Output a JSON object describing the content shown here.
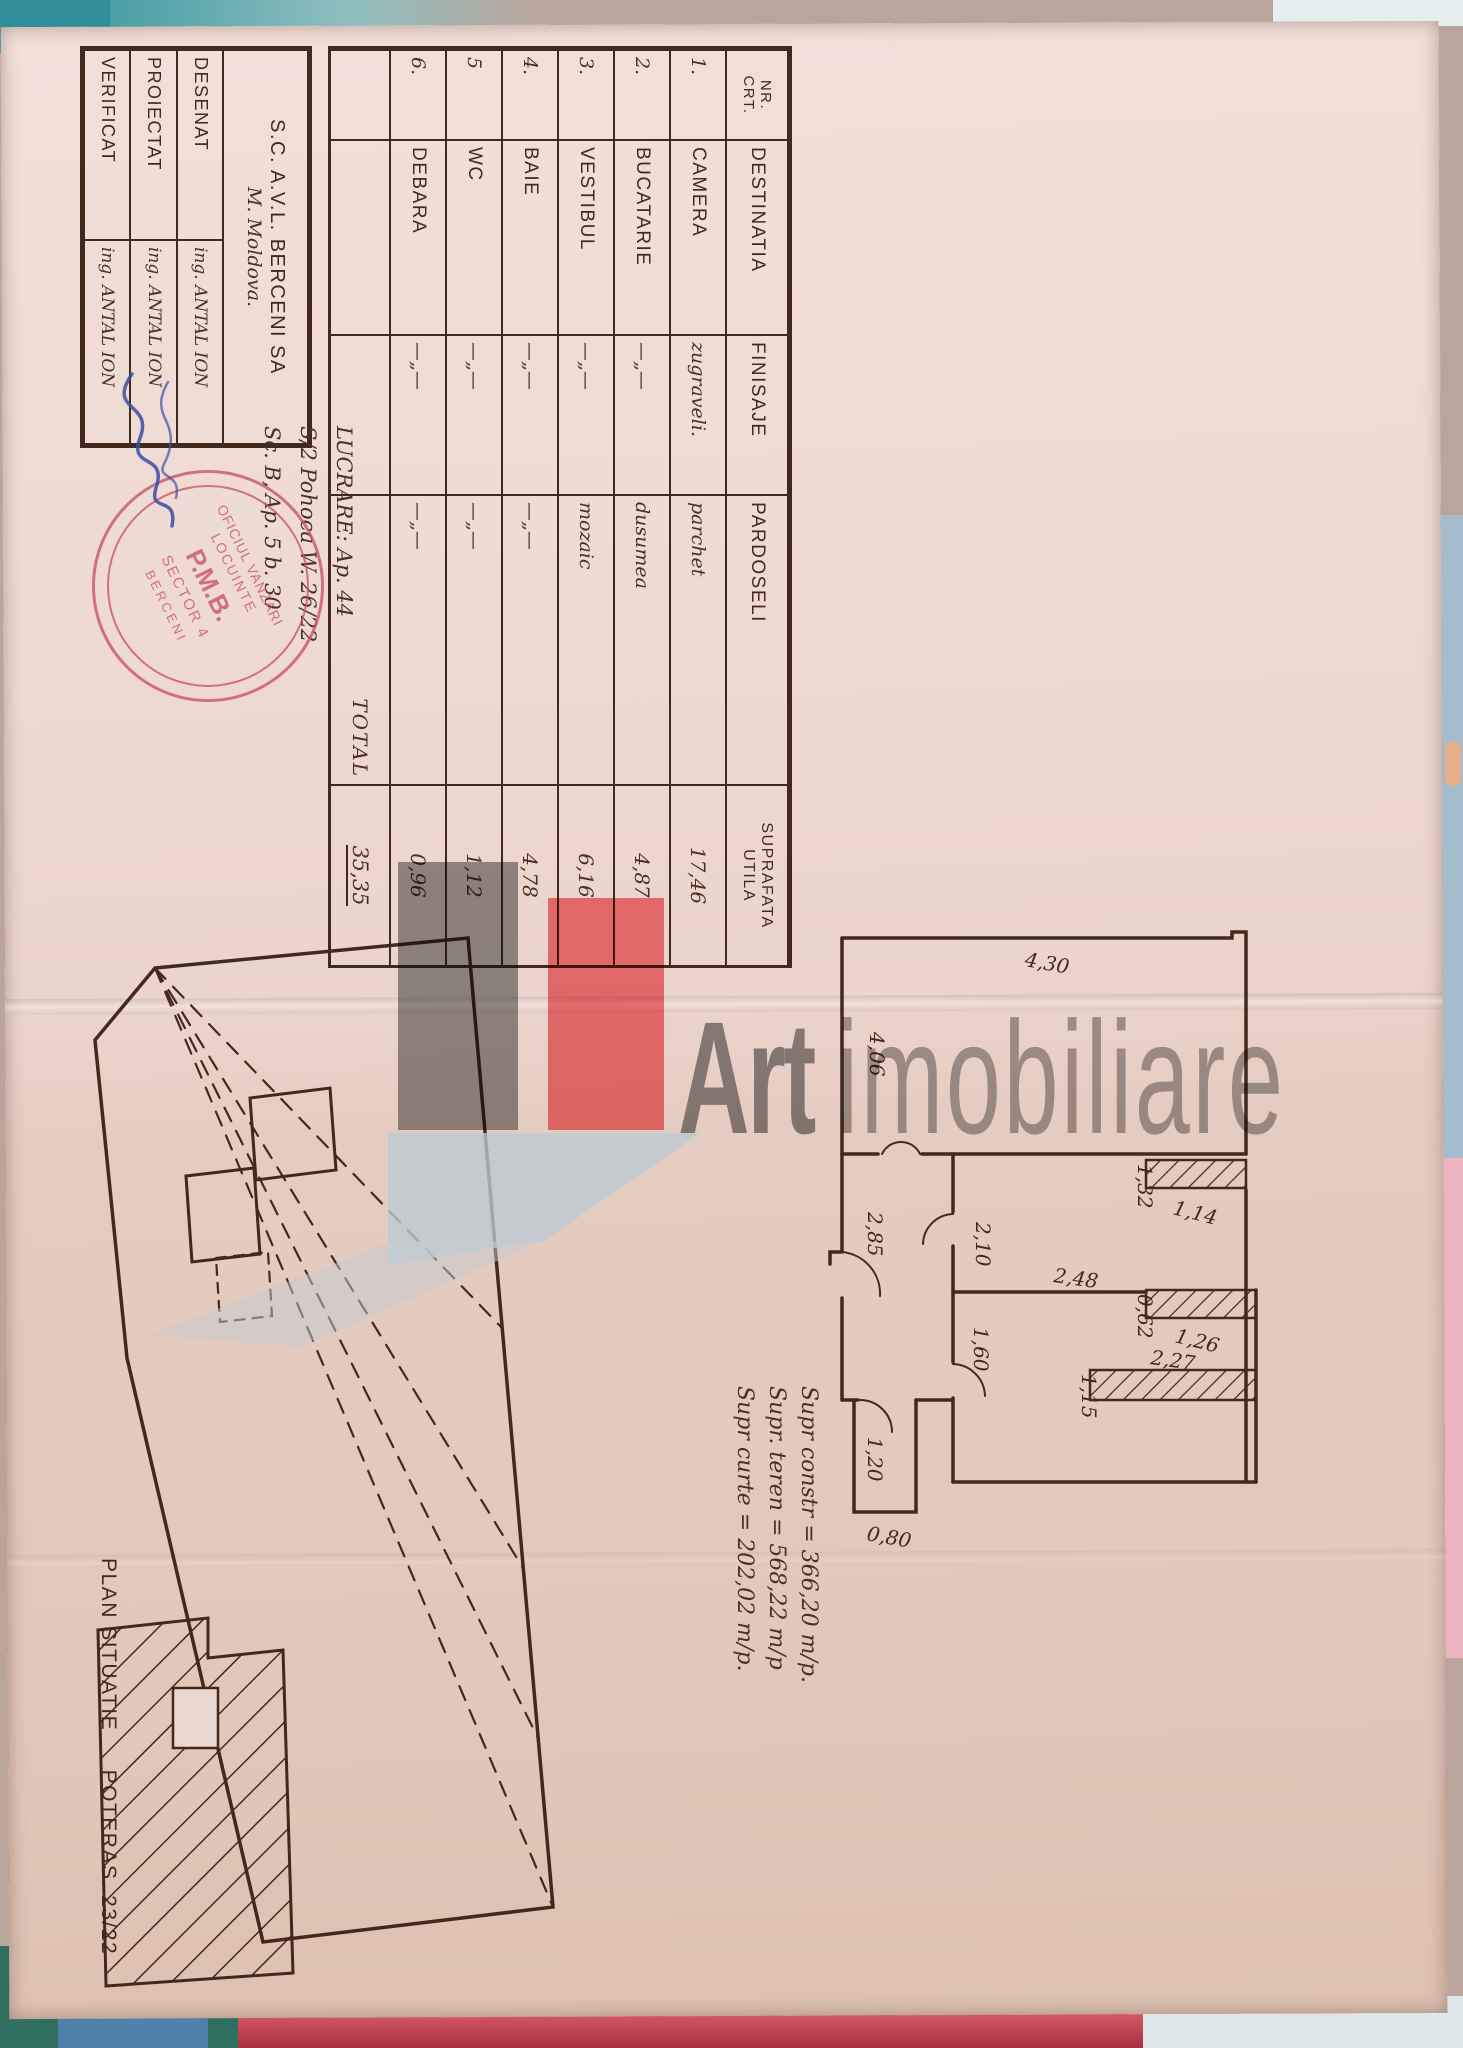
{
  "colors": {
    "ink": "#42291b",
    "paper": "#ead7cf",
    "stamp_red": "#c9566a",
    "signature_blue": "#3c4ea6",
    "watermark_red": "#f4757b",
    "watermark_gray": "#8e8e8e"
  },
  "watermark": {
    "brand_bold": "Art",
    "brand_light": "imobiliare"
  },
  "title_block": {
    "company_line1": "S.C. A.V.L. BERCENI SA",
    "company_line2": "M. Moldova.",
    "rows": [
      {
        "label": "DESENAT",
        "name": "ing. ANTAL ION"
      },
      {
        "label": "PROIECTAT",
        "name": "ing. ANTAL ION"
      },
      {
        "label": "VERIFICAT",
        "name": "ing. ANTAL ION"
      }
    ]
  },
  "work_note": {
    "line1": "LUCRARE: Ap. 44",
    "line2": "S/2 Pohoca W. 26/22",
    "line3": "Sc. B, Ap. 5  b. 30"
  },
  "stamp": {
    "top": "OFICIUL VANZARI",
    "mid": "LOCUINTE",
    "org": "P.M.B.",
    "sector": "SECTOR 4",
    "bottom": "BERCENI"
  },
  "room_table": {
    "col_nr_1": "NR.",
    "col_nr_2": "CRT.",
    "col_dest": "DESTINATIA",
    "col_fin": "FINISAJE",
    "col_pard": "PARDOSELI",
    "col_supr_1": "SUPRAFATA",
    "col_supr_2": "UTILA",
    "rows": [
      {
        "nr": "1.",
        "name": "CAMERA",
        "finish": "zugraveli.",
        "floor": "parchet",
        "area": "17,46"
      },
      {
        "nr": "2.",
        "name": "BUCATARIE",
        "finish": "—„—",
        "floor": "dusumea",
        "area": "4,87"
      },
      {
        "nr": "3.",
        "name": "VESTIBUL",
        "finish": "—„—",
        "floor": "mozaic",
        "area": "6,16"
      },
      {
        "nr": "4.",
        "name": "BAIE",
        "finish": "—„—",
        "floor": "—„—",
        "area": "4,78"
      },
      {
        "nr": "5",
        "name": "WC",
        "finish": "—„—",
        "floor": "—„—",
        "area": "1,12"
      },
      {
        "nr": "6.",
        "name": "DEBARA",
        "finish": "—„—",
        "floor": "—„—",
        "area": "0,96"
      }
    ],
    "total_label": "TOTAL",
    "total_value": "35,35"
  },
  "floor_plan": {
    "dim_top": "4,30",
    "dim_left": "4,06",
    "dim_hall": "2,85",
    "dim_door_upper": "2,10",
    "dim_door_lower": "1,60",
    "dim_mid": "2,48",
    "dim_wall1_v": "1,32",
    "dim_wall1_h": "1,14",
    "dim_wall2_v": "0,62",
    "dim_wall2_h": "1,26",
    "dim_wall3_v": "1,15",
    "dim_wall3_h": "2,27",
    "dim_entry_depth": "1,20",
    "dim_entry_width": "0,80"
  },
  "site_plan": {
    "caption_plan": "PLAN SITUATIE",
    "caption_street": "POTERAS. 23/22",
    "areas": {
      "line1": "Supr constr = 366,20 m/p.",
      "line2": "Supr. teren = 568,22 m/p",
      "line3": "Supr curte = 202,02 m/p."
    }
  }
}
